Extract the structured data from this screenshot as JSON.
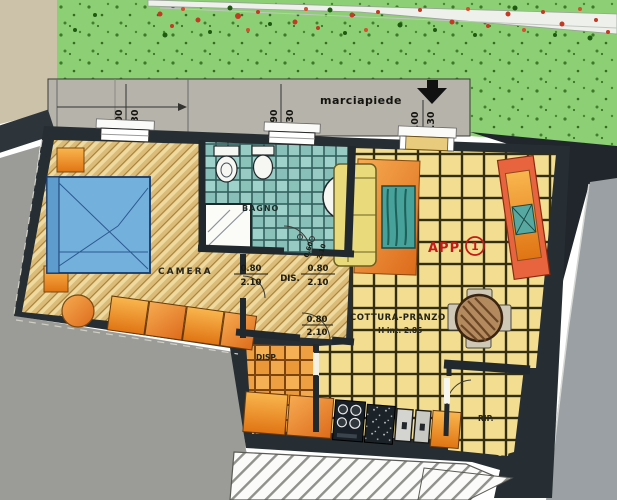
{
  "plan": {
    "apartment": {
      "label": "APP.",
      "number": "1"
    },
    "sidewalk": {
      "label": "marciapiede"
    },
    "rooms": {
      "camera": "CAMERA",
      "bagno": "BAGNO",
      "dis": "DIS.",
      "cottura": "COTTURA-PRANZO",
      "cottura_height": "H int. 2.85",
      "disp": "DISP.",
      "rip": "RIP."
    },
    "dimensions": {
      "window_left_a": "1.00",
      "window_left_b": "1.30",
      "window_mid_a": "0.90",
      "window_mid_b": "1.30",
      "entrance_a": "1.00",
      "entrance_b": "2.30",
      "door_hall_left_w": "0.80",
      "door_hall_left_h": "2.10",
      "door_hall_right_w": "0.80",
      "door_hall_right_h": "2.10",
      "door_kitchen_w": "0.80",
      "door_kitchen_h": "2.10",
      "door_bath_w": "0.60",
      "door_bath_h": "2.10"
    },
    "colors": {
      "grass": "#8ccf74",
      "sidewalk": "#b6b3ab",
      "wall": "#262e33",
      "bedroom_floor": "#eeda9e",
      "bath_tile": "#8fc5bf",
      "kitchen_tile": "#f2dd90",
      "pantry_tile": "#f0a148",
      "accent_red": "#c41a1a",
      "furniture_orange": "#ef9440",
      "bed_blue": "#74b0dc",
      "road": "#9aa0a3"
    }
  }
}
